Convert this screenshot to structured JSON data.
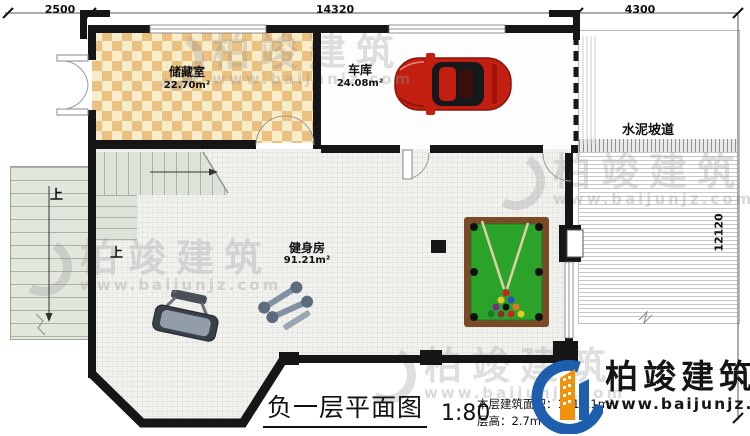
{
  "dimensions": {
    "top_left": "2500",
    "top_middle": "14320",
    "top_right": "4300",
    "right_side": "12120"
  },
  "rooms": {
    "storage": {
      "name": "储藏室",
      "area": "22.70m²"
    },
    "garage": {
      "name": "车库",
      "area": "24.08m²"
    },
    "gym": {
      "name": "健身房",
      "area": "91.21m²"
    }
  },
  "labels": {
    "ramp": "水泥坡道",
    "stair_up_outdoor": "上",
    "stair_up_indoor": "上"
  },
  "title": {
    "name": "负一层平面图",
    "scale": "1:80",
    "area_line": "本层建筑面积：141.11m²",
    "height_line": "层高：2.7m"
  },
  "brand": {
    "name": "柏竣建筑",
    "url": "www.baijunjz.com"
  },
  "watermark": {
    "name": "柏竣建筑",
    "url": "www.baijunjz.com"
  },
  "colors": {
    "wall": "#161616",
    "storage_tile_dark": "#eac181",
    "storage_tile_light": "#f8ecc9",
    "stair": "#dde3d8",
    "pool_felt": "#2ba32b",
    "pool_frame": "#7a4a27",
    "car_red": "#c21f10",
    "logo_blue": "#1d5fae",
    "logo_orange": "#f2920a"
  }
}
